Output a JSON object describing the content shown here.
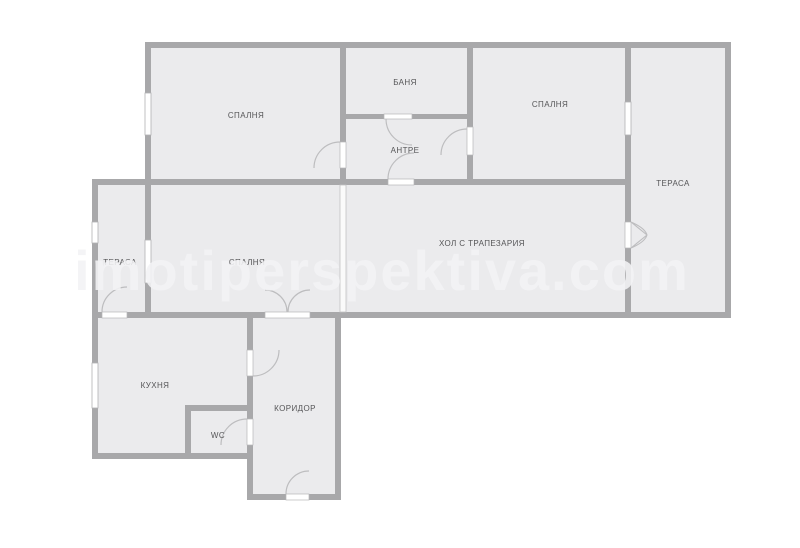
{
  "plan": {
    "type": "apartment-floor-plan",
    "watermark": {
      "text": "imotiperspektiva.com"
    },
    "palette": {
      "background": "#ffffff",
      "wall": "#a8a8aa",
      "room_fill": "#ebebed",
      "label_color": "#555557",
      "door_arc": "#bdbdbf",
      "watermark_color": "rgba(243,243,245,0.88)"
    },
    "rooms": [
      {
        "id": "bedroom-top-left",
        "label": "СПАЛНЯ"
      },
      {
        "id": "bathroom",
        "label": "БАНЯ"
      },
      {
        "id": "entry-hall",
        "label": "АНТРЕ"
      },
      {
        "id": "bedroom-top-right",
        "label": "СПАЛНЯ"
      },
      {
        "id": "terrace-right",
        "label": "ТЕРАСА"
      },
      {
        "id": "living-dining",
        "label": "ХОЛ С ТРАПЕЗАРИЯ"
      },
      {
        "id": "terrace-left",
        "label": "ТЕРАСА"
      },
      {
        "id": "bedroom-left",
        "label": "СПАЛНЯ"
      },
      {
        "id": "kitchen",
        "label": "КУХНЯ"
      },
      {
        "id": "wc",
        "label": "WC"
      },
      {
        "id": "corridor",
        "label": "КОРИДОР"
      }
    ]
  }
}
